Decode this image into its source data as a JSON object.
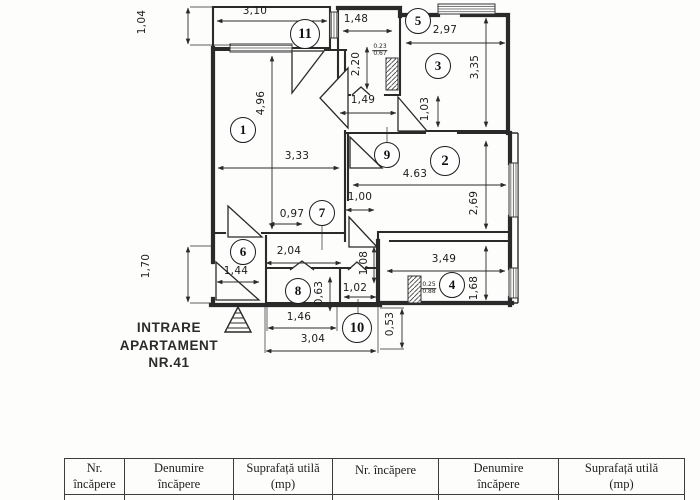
{
  "plan": {
    "entrance": {
      "line1": "INTRARE",
      "line2": "APARTAMENT",
      "line3": "NR.41"
    },
    "rooms": {
      "r1": "1",
      "r2": "2",
      "r3": "3",
      "r4": "4",
      "r5": "5",
      "r6": "6",
      "r7": "7",
      "r8": "8",
      "r9": "9",
      "r10": "10",
      "r11": "11"
    },
    "dims": {
      "d104": "1,04",
      "d310": "3,10",
      "d148": "1,48",
      "d297": "2,97",
      "d220": "2,20",
      "d496": "4,96",
      "d149": "1,49",
      "d103": "1,03",
      "d335": "3,35",
      "d333": "3,33",
      "d463": "4.63",
      "d269": "2,69",
      "d100": "1,00",
      "d097": "0,97",
      "d204": "2,04",
      "d144": "1,44",
      "d108": "1,08",
      "d170": "1,70",
      "d349": "3,49",
      "d063": "0,63",
      "d102": "1,02",
      "d168": "1,68",
      "d146": "1,46",
      "d053": "0,53",
      "d304": "3,04"
    },
    "shafts": {
      "s1_top": "0.23",
      "s1_bot": "0.67",
      "s2_top": "0.25",
      "s2_bot": "0.88"
    },
    "line_color": "#2a2a2a"
  },
  "table": {
    "headers": [
      {
        "l1": "Nr.",
        "l2": "încăpere"
      },
      {
        "l1": "Denumire",
        "l2": "încăpere"
      },
      {
        "l1": "Suprafață utilă",
        "l2": "(mp)"
      },
      {
        "l1": "Nr. încăpere",
        "l2": ""
      },
      {
        "l1": "Denumire",
        "l2": "încăpere"
      },
      {
        "l1": "Suprafață utilă",
        "l2": "(mp)"
      }
    ]
  }
}
